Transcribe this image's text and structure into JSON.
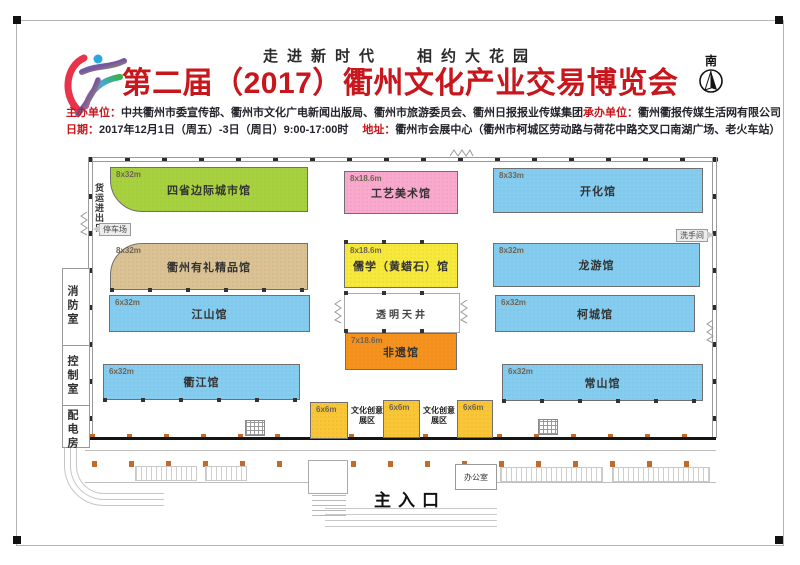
{
  "header": {
    "slogan_left": "走进新时代",
    "slogan_right": "相约大花园",
    "title": "第二届（2017）衢州文化产业交易博览会",
    "compass_label": "南",
    "organizer_label": "主办单位：",
    "organizer_value": "中共衢州市委宣传部、衢州市文化广电新闻出版局、衢州市旅游委员会、衢州日报报业传媒集团",
    "co_organizer_label": "承办单位：",
    "co_organizer_value": "衢州衢报传媒生活网有限公司",
    "date_label": "日期：",
    "date_value": "2017年12月1日（周五）-3日（周日）9:00-17:00时",
    "address_label": "地址：",
    "address_value": "衢州市会展中心（衢州市柯城区劳动路与荷花中路交叉口南湖广场、老火车站）"
  },
  "floorplan": {
    "halls": [
      {
        "name": "四省边际城市馆",
        "size": "8x32m"
      },
      {
        "name": "工艺美术馆",
        "size": "8x18.6m"
      },
      {
        "name": "开化馆",
        "size": "8x33m"
      },
      {
        "name": "衢州有礼精品馆",
        "size": "8x32m"
      },
      {
        "name": "儒学（黄蜡石）馆",
        "size": "8x18.6m"
      },
      {
        "name": "龙游馆",
        "size": "8x32m"
      },
      {
        "name": "江山馆",
        "size": "6x32m"
      },
      {
        "name": "柯城馆",
        "size": "6x32m"
      },
      {
        "name": "非遗馆",
        "size": "7x18.6m"
      },
      {
        "name": "衢江馆",
        "size": "6x32m"
      },
      {
        "name": "常山馆",
        "size": "6x32m"
      }
    ],
    "creative_blocks": {
      "size": "6x6m",
      "label": "文化创意展区"
    },
    "atrium_label": "透明天井",
    "main_entrance": "主入口",
    "office": "办公室",
    "restroom": "洗手间",
    "parking": "停车场",
    "freight_entrance": "货运进出口",
    "fire_room": "消防室",
    "control_room": "控制室",
    "power_room": "配电房",
    "colors": {
      "title_red": "#c8161d",
      "hall_green": "#a8d13f",
      "hall_pink": "#f9a9ce",
      "hall_blue": "#85cdf0",
      "hall_tan": "#dbc294",
      "hall_yellow": "#f6e93b",
      "hall_orange": "#f6921e",
      "creative_amber": "#f8c636"
    }
  }
}
